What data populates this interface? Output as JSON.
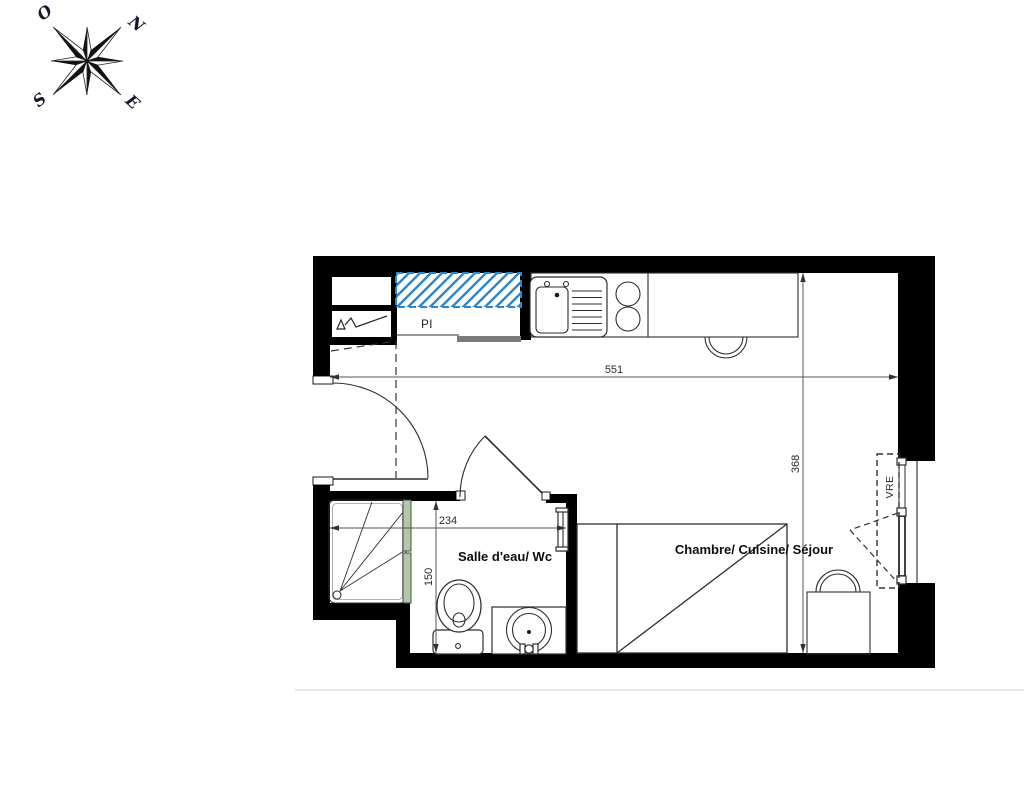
{
  "compass": {
    "north": "N",
    "west": "O",
    "south": "S",
    "east": "E"
  },
  "rooms": {
    "bathroom_label": "Salle d'eau/ Wc",
    "main_room_label": "Chambre/ Cuisine/ Séjour"
  },
  "labels": {
    "closet": "PI",
    "shutter": "VRE"
  },
  "dimensions": {
    "total_width_cm": "551",
    "total_depth_cm": "368",
    "bathroom_width_cm": "234",
    "bathroom_depth_cm": "150"
  },
  "colors": {
    "accent_blue": "#2f86cb",
    "glass_green": "#b3c7ab",
    "wall_black": "#000000"
  }
}
